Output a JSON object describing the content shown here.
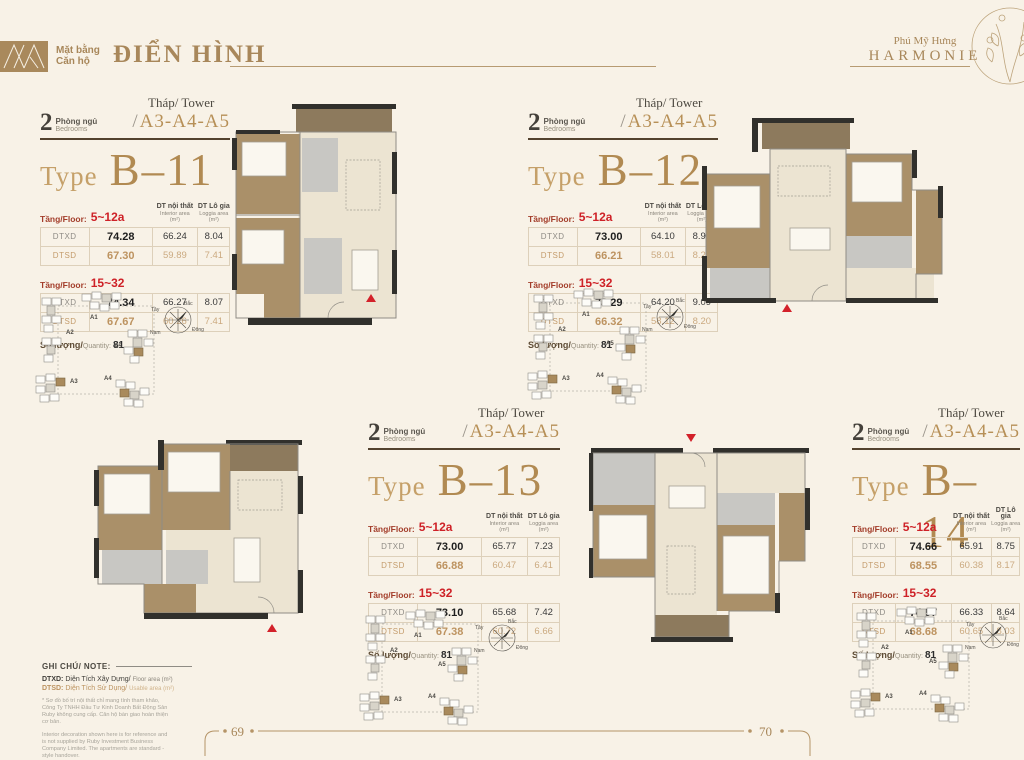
{
  "page": {
    "header": {
      "logo_line1": "Mặt bằng",
      "logo_line2": "Căn hộ",
      "title": "ĐIỂN HÌNH",
      "brand_line1": "Phú Mỹ Hưng",
      "brand_line2": "HARMONIE"
    },
    "footer": {
      "page_left": "69",
      "page_right": "70"
    }
  },
  "labels": {
    "bedrooms_count": "2",
    "bedrooms_vn": "Phòng ngủ",
    "bedrooms_en": "Bedrooms",
    "tower_label": "Tháp/ Tower",
    "tower_slash": "/",
    "tower_value": "A3-A4-A5",
    "type_label": "Type",
    "floor_label": "Tầng/Floor:",
    "col_interior_vn": "DT nội thất",
    "col_interior_en": "Interior area",
    "col_unit": "(m²)",
    "col_loggia_vn": "DT Lô gia",
    "col_loggia_en": "Loggia area",
    "row_dtxd": "DTXD",
    "row_dtsd": "DTSD",
    "quantity_vn": "Số lượng/",
    "quantity_en": "Quantity:"
  },
  "units": [
    {
      "type": "B–11",
      "quantity": "81",
      "sections": [
        {
          "range": "5~12a",
          "dtxd": [
            "74.28",
            "66.24",
            "8.04"
          ],
          "dtsd": [
            "67.30",
            "59.89",
            "7.41"
          ]
        },
        {
          "range": "15~32",
          "dtxd": [
            "74.34",
            "66.27",
            "8.07"
          ],
          "dtsd": [
            "67.67",
            "60.26",
            "7.41"
          ]
        }
      ]
    },
    {
      "type": "B–12",
      "quantity": "81",
      "sections": [
        {
          "range": "5~12a",
          "dtxd": [
            "73.00",
            "64.10",
            "8.90"
          ],
          "dtsd": [
            "66.21",
            "58.01",
            "8.20"
          ]
        },
        {
          "range": "15~32",
          "dtxd": [
            "73.29",
            "64.20",
            "9.09"
          ],
          "dtsd": [
            "66.32",
            "58.12",
            "8.20"
          ]
        }
      ]
    },
    {
      "type": "B–13",
      "quantity": "81",
      "sections": [
        {
          "range": "5~12a",
          "dtxd": [
            "73.00",
            "65.77",
            "7.23"
          ],
          "dtsd": [
            "66.88",
            "60.47",
            "6.41"
          ]
        },
        {
          "range": "15~32",
          "dtxd": [
            "73.10",
            "65.68",
            "7.42"
          ],
          "dtsd": [
            "67.38",
            "60.72",
            "6.66"
          ]
        }
      ]
    },
    {
      "type": "B–14",
      "quantity": "81",
      "sections": [
        {
          "range": "5~12a",
          "dtxd": [
            "74.66",
            "65.91",
            "8.75"
          ],
          "dtsd": [
            "68.55",
            "60.38",
            "8.17"
          ]
        },
        {
          "range": "15~32",
          "dtxd": [
            "74.97",
            "66.33",
            "8.64"
          ],
          "dtsd": [
            "68.68",
            "60.65",
            "8.03"
          ]
        }
      ]
    }
  ],
  "sitemap": {
    "buildings": [
      "A1",
      "A2",
      "A3",
      "A4",
      "A5"
    ],
    "compass": {
      "west": "Tây",
      "north": "Bắc",
      "east": "Đông",
      "south": "Nam"
    }
  },
  "note": {
    "heading": "GHI CHÚ/ NOTE:",
    "dtxd_term": "DTXD:",
    "dtxd_vn": "Diện Tích Xây Dựng/",
    "dtxd_en": "Floor area (m²)",
    "dtsd_term": "DTSD:",
    "dtsd_vn": "Diện Tích Sử Dụng/",
    "dtsd_en": "Usable area (m²)",
    "fine_print_vn": "* Sơ đồ bố trí nội thất chỉ mang tính tham khảo, Công Ty TNHH Đầu Tư Kinh Doanh Bất Động Sản Ruby không cung cấp. Căn hộ bàn giao hoàn thiện cơ bản.",
    "fine_print_en": "Interior decoration shown here is for reference and is not supplied by Ruby Investment Business Company Limited. The apartments are standard - style handover."
  },
  "colors": {
    "background": "#f8f2e7",
    "brand_brown": "#a8875a",
    "type_gold": "#b18a52",
    "accent_red": "#ce2127",
    "dtsd_tan": "#bc9360",
    "wall_dark": "#31302c"
  }
}
